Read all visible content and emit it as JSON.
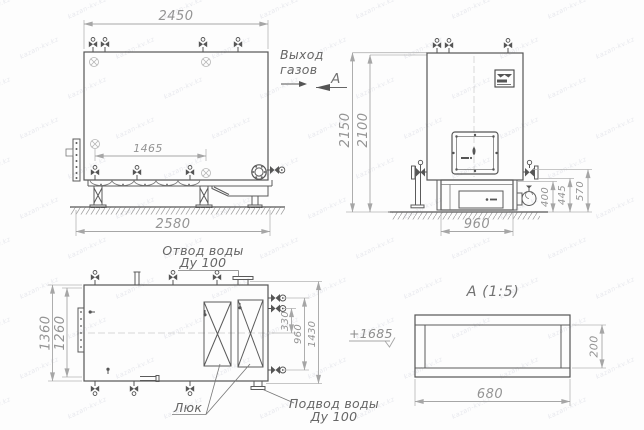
{
  "watermark": "kazan-kv.kz",
  "side_view": {
    "dim_width_top": "2450",
    "dim_manholes": "1465",
    "dim_base": "2580",
    "label_gas_1": "Выход",
    "label_gas_2": "газов",
    "section_arrow_letter": "А"
  },
  "front_view": {
    "dim_height_total": "2150",
    "dim_height_body": "2100",
    "dim_right_400": "400",
    "dim_right_445": "445",
    "dim_right_570": "570",
    "dim_base_width": "960"
  },
  "plan_view": {
    "dim_depth_total": "1360",
    "dim_depth_inner": "1260",
    "dim_330": "330",
    "dim_960": "960",
    "dim_1430": "1430",
    "label_water_out_1": "Отвод воды",
    "label_water_out_2": "Ду 100",
    "label_water_in_1": "Подвод воды",
    "label_water_in_2": "Ду 100",
    "label_hatch": "Люк",
    "level_mark": "+1685"
  },
  "section_view": {
    "title": "А  (1:5)",
    "dim_width": "680",
    "dim_height": "200"
  }
}
